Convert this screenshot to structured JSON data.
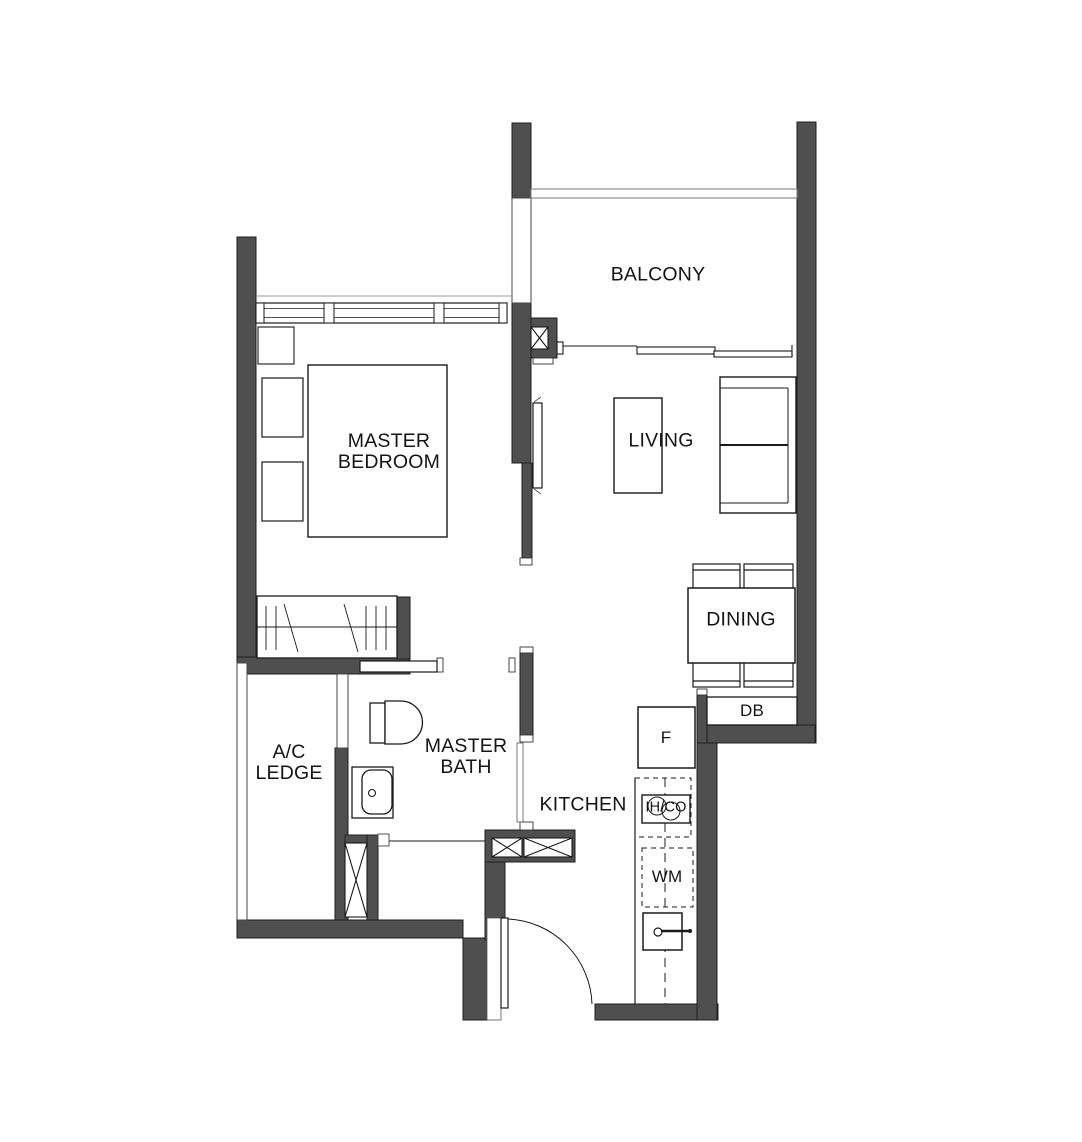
{
  "colors": {
    "wall": "#4f4f4f",
    "line": "#1a1a1a",
    "background": "#ffffff"
  },
  "labels": {
    "balcony": "BALCONY",
    "living": "LIVING",
    "dining": "DINING",
    "kitchen": "KITCHEN",
    "master_bedroom_line1": "MASTER",
    "master_bedroom_line2": "BEDROOM",
    "master_bath_line1": "MASTER",
    "master_bath_line2": "BATH",
    "ac_ledge_line1": "A/C",
    "ac_ledge_line2": "LEDGE",
    "db": "DB",
    "fridge": "F",
    "hob": "IH/CO",
    "washing_machine": "WM"
  }
}
